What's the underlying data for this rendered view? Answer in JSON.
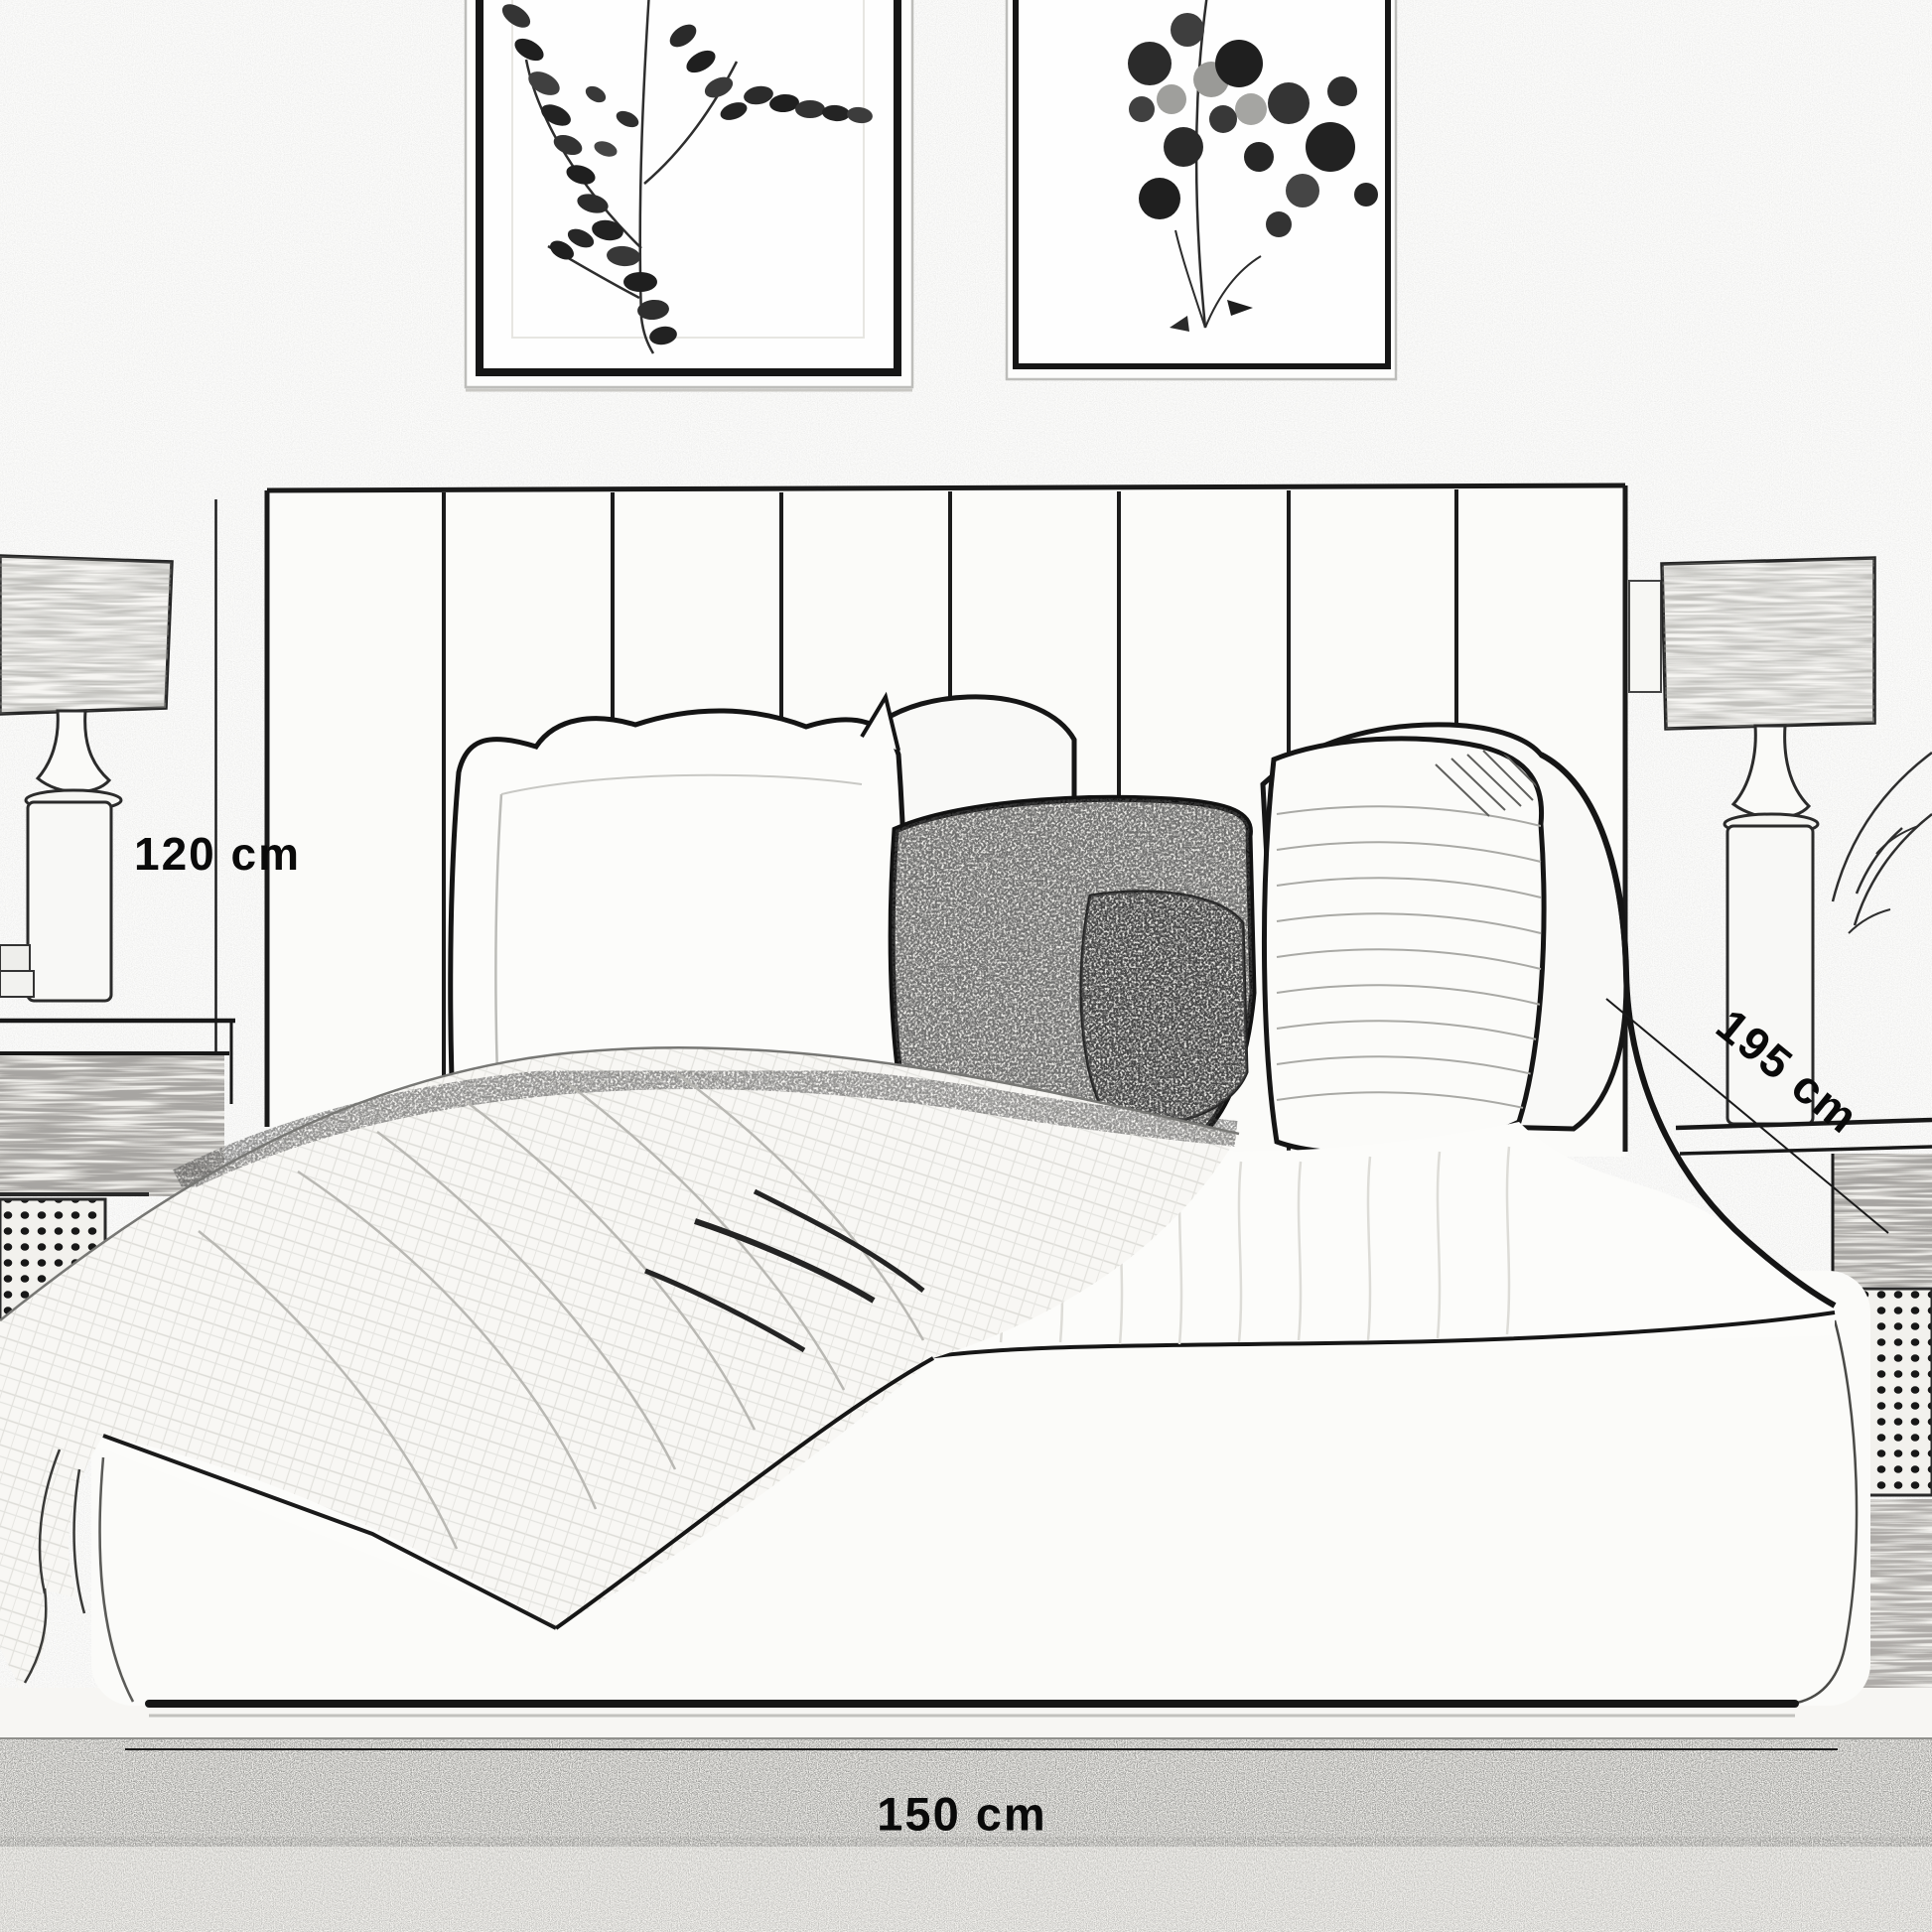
{
  "meta": {
    "description": "Bed product dimension sketch"
  },
  "dimensions": {
    "height": {
      "label": "120 cm"
    },
    "depth": {
      "label": "195 cm"
    },
    "width": {
      "label": "150 cm"
    }
  },
  "colors": {
    "background": "#fcfcfb",
    "ink": "#141414",
    "label_text": "#0a0a0a",
    "light_line": "#bdbdba"
  },
  "scene_objects": [
    "framed-botanical-print-left",
    "framed-botanical-print-right",
    "panel-headboard",
    "bed-base",
    "duvet",
    "pillows",
    "throw-blanket",
    "nightstand-left",
    "nightstand-right",
    "table-lamp-left",
    "table-lamp-right",
    "rug"
  ]
}
